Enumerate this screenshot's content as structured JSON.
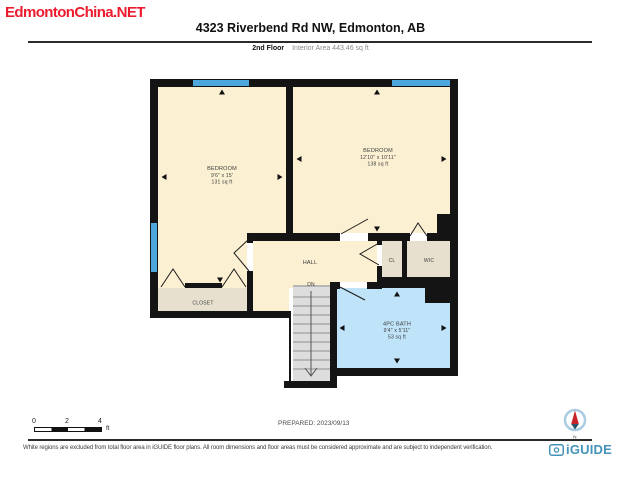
{
  "watermark": {
    "text": "EdmontonChina.NET",
    "color": "#EC1B2E"
  },
  "header": {
    "title": "4323 Riverbend Rd NW, Edmonton, AB"
  },
  "floor_info": {
    "floor": "2nd Floor",
    "interior_area": "Interior Area 443.46 sq ft"
  },
  "rooms": {
    "bedroom_left": {
      "name": "BEDROOM",
      "dims": "9'6\" x 15'",
      "area": "131 sq ft"
    },
    "bedroom_right": {
      "name": "BEDROOM",
      "dims": "12'10\" x 10'11\"",
      "area": "138 sq ft"
    },
    "hall": {
      "name": "HALL"
    },
    "stairs": {
      "label": "DN"
    },
    "cl": {
      "name": "CL"
    },
    "wic": {
      "name": "WIC"
    },
    "closet": {
      "name": "CLOSET"
    },
    "bath": {
      "name": "4PC BATH",
      "dims": "9'4\" x 5'11\"",
      "area": "53 sq ft"
    }
  },
  "scale_bar": {
    "ticks": [
      "0",
      "2",
      "4"
    ],
    "unit": "ft"
  },
  "footer": {
    "prepared": "PREPARED: 2023/09/13",
    "disclaimer": "White regions are excluded from total floor area in iGUIDE floor plans. All room dimensions and floor areas must be considered approximate and are subject to independent verification.",
    "brand": "iGUIDE",
    "compass_north": "N"
  },
  "colors": {
    "floor_cream": "#FBF0D2",
    "closet_grey": "#E7E0CF",
    "bath_blue": "#BFE3F8",
    "window_blue": "#4DA6DC",
    "wall_black": "#141414",
    "stairs_grey": "#DDDDDD",
    "brand_teal": "#4493B8",
    "logo_red": "#EC1B2E"
  }
}
